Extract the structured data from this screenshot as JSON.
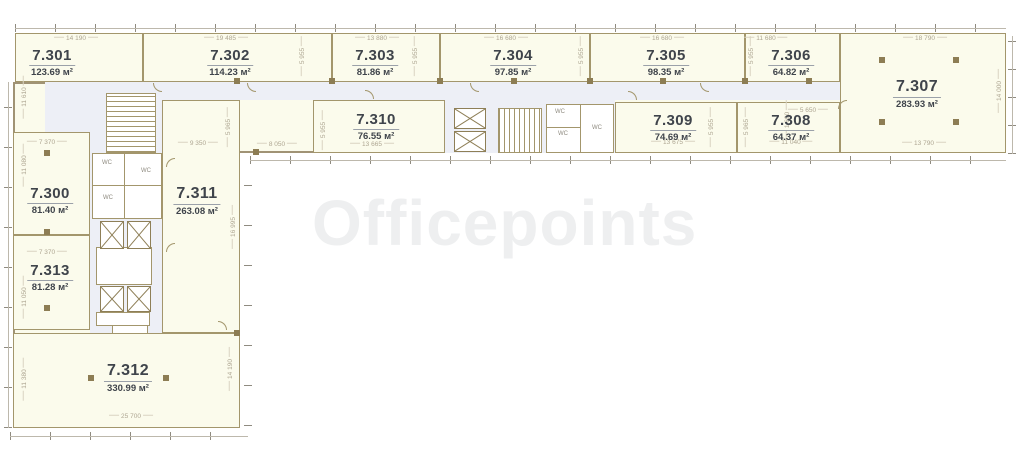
{
  "watermark": "Officepoints",
  "rooms": [
    {
      "number": "7.301",
      "area": "123.69 м²"
    },
    {
      "number": "7.302",
      "area": "114.23 м²"
    },
    {
      "number": "7.303",
      "area": "81.86 м²"
    },
    {
      "number": "7.304",
      "area": "97.85 м²"
    },
    {
      "number": "7.305",
      "area": "98.35 м²"
    },
    {
      "number": "7.306",
      "area": "64.82 м²"
    },
    {
      "number": "7.307",
      "area": "283.93 м²"
    },
    {
      "number": "7.308",
      "area": "64.37 м²"
    },
    {
      "number": "7.309",
      "area": "74.69 м²"
    },
    {
      "number": "7.310",
      "area": "76.55 м²"
    },
    {
      "number": "7.311",
      "area": "263.08 м²"
    },
    {
      "number": "7.300",
      "area": "81.40 м²"
    },
    {
      "number": "7.312",
      "area": "330.99 м²"
    },
    {
      "number": "7.313",
      "area": "81.28 м²"
    }
  ],
  "dims": [
    "14 190",
    "19 485",
    "13 880",
    "16 680",
    "16 680",
    "11 680",
    "18 790",
    "11 610",
    "11 080",
    "11 050",
    "11 380",
    "7 370",
    "7 370",
    "9 350",
    "8 050",
    "13 665",
    "13 675",
    "11 040",
    "5 650",
    "1 690",
    "13 790",
    "25 700",
    "14 190",
    "16 995",
    "14 000",
    "5 955",
    "5 955",
    "5 955",
    "5 955",
    "5 955",
    "5 965",
    "5 955",
    "5 965"
  ],
  "labels": {
    "wc": "WC"
  },
  "colors": {
    "room_fill": "#fbfbec",
    "corridor_fill": "#edeff6",
    "wall": "#a3966c",
    "dim_text": "#aea692",
    "label_text": "#3f444b",
    "column": "#8d7d54"
  }
}
